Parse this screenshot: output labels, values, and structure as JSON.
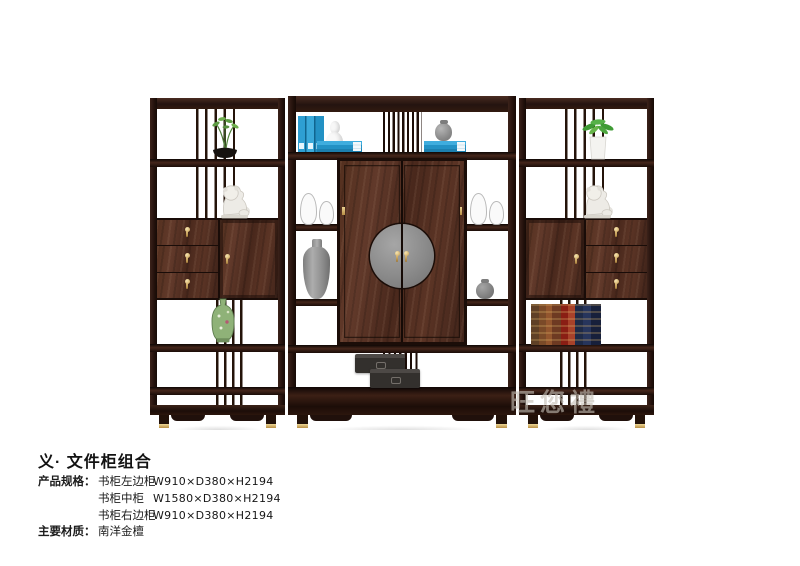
{
  "product": {
    "title": "义· 文件柜组合",
    "spec_label": "产品规格：",
    "material_label": "主要材质：",
    "specs": [
      {
        "name": "书柜左边柜",
        "dims": "W910×D380×H2194"
      },
      {
        "name": "书柜中柜",
        "dims": "W1580×D380×H2194"
      },
      {
        "name": "书柜右边柜",
        "dims": "W910×D380×H2194"
      }
    ],
    "material": "南洋金檀",
    "watermark": "旺您禮"
  },
  "photo": {
    "description": "three-piece Chinese-style dark wood display / file cabinet combination",
    "decor_items": [
      "bonsai-plant",
      "foo-dog-statue",
      "green-porcelain-vase",
      "blue-books",
      "white-gourd-vase",
      "gray-jar",
      "glass-vases",
      "gray-urn",
      "black-gift-boxes",
      "leather-books",
      "potted-green-plant"
    ],
    "colors": {
      "wood_dark": "#2a1713",
      "wood_panel": "#54301f",
      "brass": "#cfa968",
      "plate_gray": "#8d8d8d",
      "book_blue": "#2f9fd3",
      "vase_green": "#8fb278"
    }
  }
}
